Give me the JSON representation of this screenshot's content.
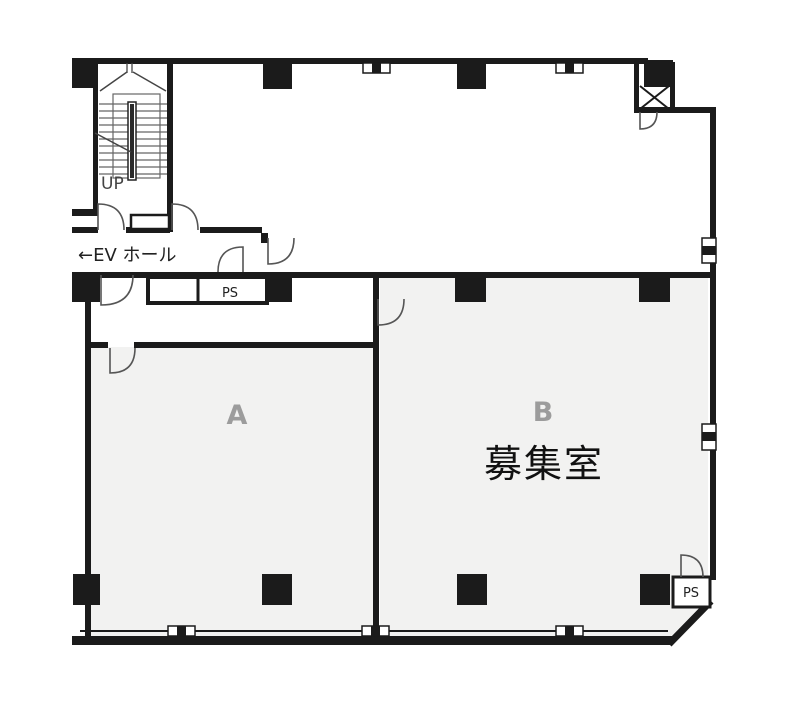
{
  "floorplan": {
    "labels": {
      "stairs_up": "UP",
      "ev_hall": "←EV ホール",
      "ps_mid": "PS",
      "ps_corner": "PS",
      "room_a": "A",
      "room_b": "B",
      "vacancy": "募集室"
    },
    "colors": {
      "wall": "#1b1b1b",
      "room_fill": "#f2f2f1",
      "room_label": "#9c9c9c",
      "text_dark": "#222222",
      "stair_line": "#666666",
      "door_line": "#555555",
      "background": "#ffffff"
    }
  }
}
